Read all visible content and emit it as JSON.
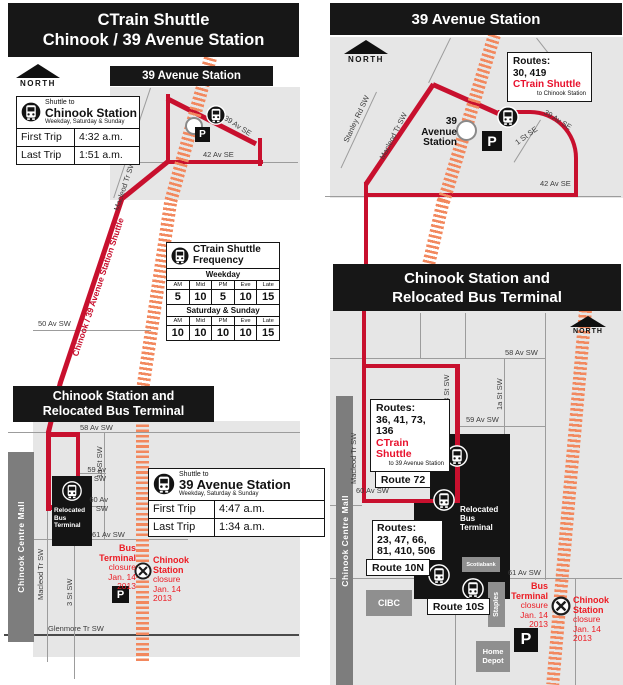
{
  "shared": {
    "north": "NORTH",
    "parking": "P"
  },
  "left": {
    "title": "CTrain Shuttle\nChinook / 39 Avenue Station",
    "station_banner": "39 Avenue Station",
    "chinook_banner": "Chinook Station and\nRelocated Bus Terminal",
    "shuttle_chinook": {
      "pre": "Shuttle to",
      "name": "Chinook Station",
      "days": "Weekday, Saturday & Sunday",
      "first_label": "First Trip",
      "first_time": "4:32 a.m.",
      "last_label": "Last Trip",
      "last_time": "1:51 a.m."
    },
    "shuttle_39": {
      "pre": "Shuttle to",
      "name": "39 Avenue Station",
      "days": "Weekday, Saturday & Sunday",
      "first_label": "First Trip",
      "first_time": "4:47 a.m.",
      "last_label": "Last Trip",
      "last_time": "1:34 a.m."
    },
    "frequency": {
      "title": "CTrain Shuttle\nFrequency",
      "weekday_band": "Weekday",
      "weekend_band": "Saturday & Sunday",
      "columns": [
        "AM",
        "Mid",
        "PM",
        "Eve",
        "Late"
      ],
      "weekday_values": [
        "5",
        "10",
        "5",
        "10",
        "15"
      ],
      "weekend_values": [
        "10",
        "10",
        "10",
        "10",
        "15"
      ]
    },
    "route_label": "Chinook / 39 Avenue Station Shuttle",
    "terminal_label": "Relocated\nBus\nTerminal",
    "mall_label": "Chinook Centre Mall",
    "closure_bus": {
      "name": "Bus\nTerminal",
      "detail": "closure\nJan. 14\n2013"
    },
    "closure_chinook": {
      "name": "Chinook\nStation",
      "detail": "closure\nJan. 14\n2013"
    },
    "streets": {
      "av39": "39 Av SE",
      "av42": "42 Av SE",
      "macleod_diag": "Macleod Tr SW",
      "av50": "50 Av SW",
      "av58": "58 Av SW",
      "st1a": "1a St SW",
      "av59": "59 Av\nSW",
      "av60": "60 Av\nSW",
      "av61": "61 Av SW",
      "glenmore": "Glenmore Tr SW",
      "macleod": "Macleod Tr SW",
      "st3": "3 St SW"
    }
  },
  "right": {
    "title": "39 Avenue Station",
    "chinook_banner": "Chinook Station and\nRelocated Bus Terminal",
    "station_label": "39\nAvenue\nStation",
    "routes_39": {
      "label": "Routes:",
      "numbers": "30, 419",
      "shuttle": "CTrain Shuttle",
      "destination": "to Chinook Station"
    },
    "routes_chinook": {
      "label": "Routes:",
      "numbers": "36, 41, 73, 136",
      "shuttle": "CTrain Shuttle",
      "destination": "to 39 Avenue Station"
    },
    "routes_mid": {
      "label": "Routes:",
      "numbers": "23, 47, 66,\n81, 410, 506"
    },
    "route_72": "Route 72",
    "route_10n": "Route 10N",
    "route_10s": "Route 10S",
    "terminal_label": "Relocated\nBus\nTerminal",
    "mall_label": "Chinook Centre Mall",
    "stores": {
      "scotiabank": "Scotiabank",
      "cibc": "CIBC",
      "staples": "Staples",
      "home_depot": "Home\nDepot"
    },
    "closure_bus": {
      "name": "Bus\nTerminal",
      "detail": "closure\nJan. 14\n2013"
    },
    "closure_chinook": {
      "name": "Chinook\nStation",
      "detail": "closure\nJan. 14\n2013"
    },
    "streets": {
      "stanley": "Stanley Rd SW",
      "macleod_diag": "Macleod Tr SW",
      "av39": "39 Av SE",
      "st1": "1 St SE",
      "av42": "42 Av SE",
      "av58": "58 Av SW",
      "st3": "3 St SW",
      "st1a": "1a St SW",
      "av59": "59 Av SW",
      "av60": "60 Av SW",
      "av61": "61 Av SW",
      "macleod": "Macleod Tr SW"
    }
  }
}
